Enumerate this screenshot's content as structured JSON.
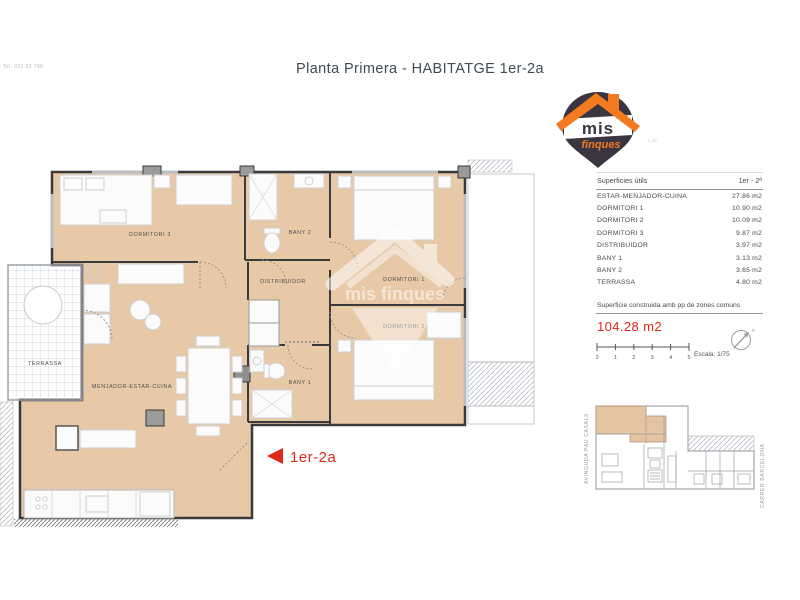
{
  "title": "Planta Primera - HABITATGE 1er-2a",
  "header_note": "Tel. 933 63 796",
  "unit_label": "1er-2a",
  "logo": {
    "word1": "mis",
    "word2": "finques",
    "side_note": "L.Mi.",
    "orange": "#f47a20",
    "charcoal": "#3a3540"
  },
  "table": {
    "header": {
      "left": "Superficies útils",
      "right": "1er - 2ª"
    },
    "rows": [
      {
        "name": "ESTAR-MENJADOR-CUINA",
        "value": "27.86 m2"
      },
      {
        "name": "DORMITORI 1",
        "value": "10.90 m2"
      },
      {
        "name": "DORMITORI 2",
        "value": "10.09 m2"
      },
      {
        "name": "DORMITORI 3",
        "value": "9.87 m2"
      },
      {
        "name": "DISTRIBUIDOR",
        "value": "3.97 m2"
      },
      {
        "name": "BANY 1",
        "value": "3.13 m2"
      },
      {
        "name": "BANY 2",
        "value": "3.65 m2"
      },
      {
        "name": "TERRASSA",
        "value": "4.80 m2"
      }
    ]
  },
  "construida": {
    "label": "Superficie construida amb pp de zones comuns",
    "value": "104.28 m2"
  },
  "scale": {
    "ticks": [
      "0",
      "1",
      "2",
      "3",
      "4",
      "5"
    ],
    "label": "Escala: 1/75",
    "north": "N"
  },
  "plan": {
    "labels": {
      "dormitori3": "DORMITORI 3",
      "bany2": "BANY 2",
      "distribuidor": "DISTRIBUIDOR",
      "dormitori1": "DORMITORI 1",
      "dormitori2": "DORMITORI 2",
      "bany1": "BANY 1",
      "menjador": "MENJADOR-ESTAR-CUINA",
      "terrassa": "TERRASSA"
    },
    "watermark": "mis finques"
  },
  "miniplan": {
    "left_street": "AVINGUDA PAU CASALS",
    "right_street": "CARRER BARCELONA"
  },
  "colors": {
    "room_fill": "#e7c9a8",
    "wall": "#3a3a3a",
    "accent_red": "#e2261c",
    "brand_orange": "#f47a20",
    "brand_charcoal": "#3a3540",
    "title": "#3f4a52"
  }
}
